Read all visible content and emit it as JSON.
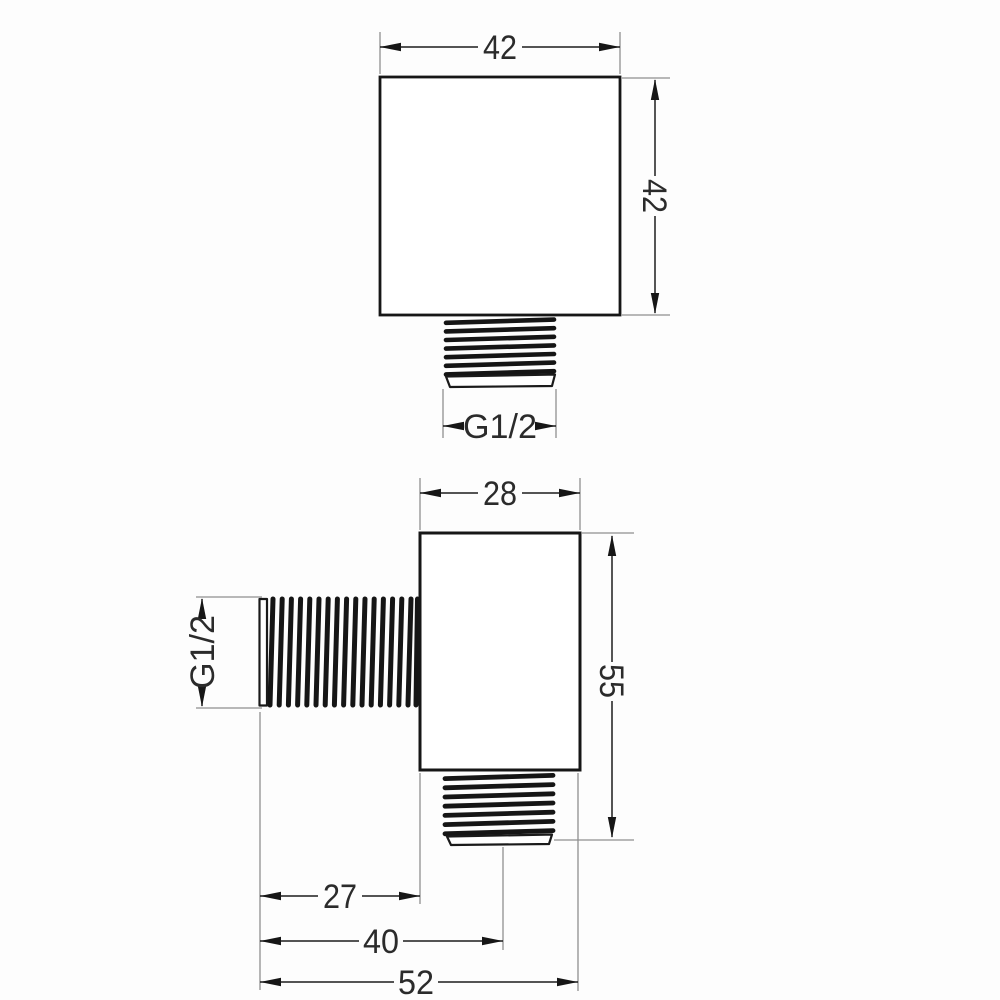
{
  "page": {
    "background": "#fdfdfd",
    "description": "Technical dimension drawing of a square shower wall elbow connector, two orthographic views"
  },
  "drawing": {
    "units": "mm",
    "colors": {
      "object_line": "#161616",
      "dimension_line": "#1d1d1d",
      "extension_line": "#8f8f8f",
      "text": "#2b2b2b"
    },
    "front_view": {
      "width": "42",
      "height": "42",
      "outlet_thread": "G1/2"
    },
    "side_view": {
      "body_width": "28",
      "height": "55",
      "wall_thread": "G1/2",
      "thread_length": "27",
      "outlet_offset": "40",
      "total_depth": "52"
    }
  }
}
